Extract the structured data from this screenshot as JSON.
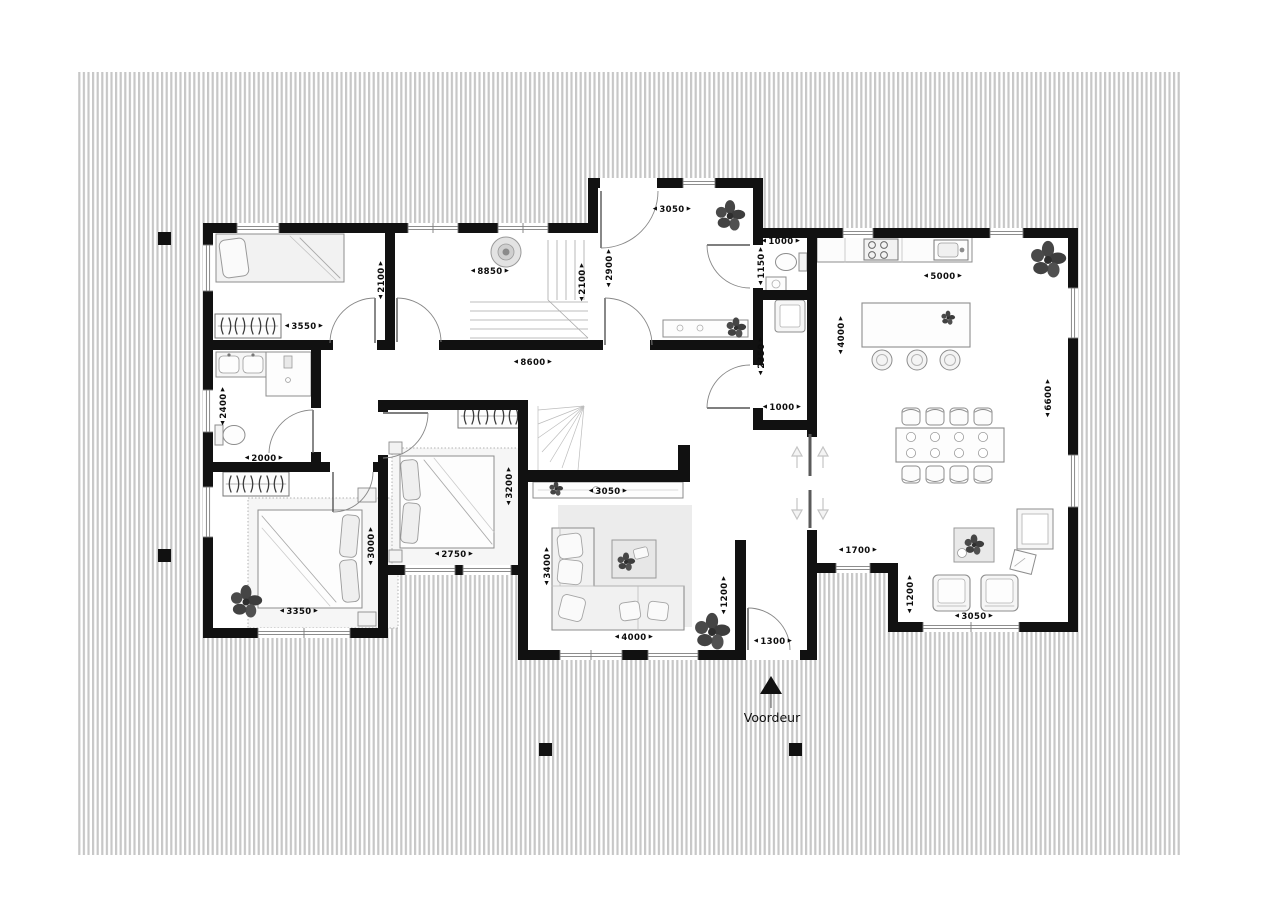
{
  "floorplan": {
    "front_door": {
      "label": "Voordeur"
    },
    "colors": {
      "wall": "#111111",
      "deck_stripe": "#c7c7c7"
    },
    "dims": {
      "bedroom1_width": "3550",
      "bedroom1_depth": "2100",
      "landing_width": "8850",
      "landing_depth": "2100",
      "entry_width": "3050",
      "entry_depth": "2900",
      "wc_width": "1000",
      "wc_depth": "1150",
      "storage_depth": "2350",
      "storage_width": "1000",
      "kitchen_width": "5000",
      "kitchen_island_depth": "4000",
      "kitchen_depth": "6600",
      "hallway_width": "8600",
      "bathroom_depth": "2400",
      "bathroom_width": "2000",
      "bedroom3_width": "3350",
      "bedroom3_depth": "3000",
      "bedroom2_width": "2750",
      "bedroom2_depth": "3200",
      "sideboard_width": "3050",
      "living_depth": "3400",
      "sofa_width": "4000",
      "vestibule_depth": "1200",
      "front_door_width": "1300",
      "passage_width": "1700",
      "nook_depth": "1200",
      "nook_width": "3050"
    }
  }
}
